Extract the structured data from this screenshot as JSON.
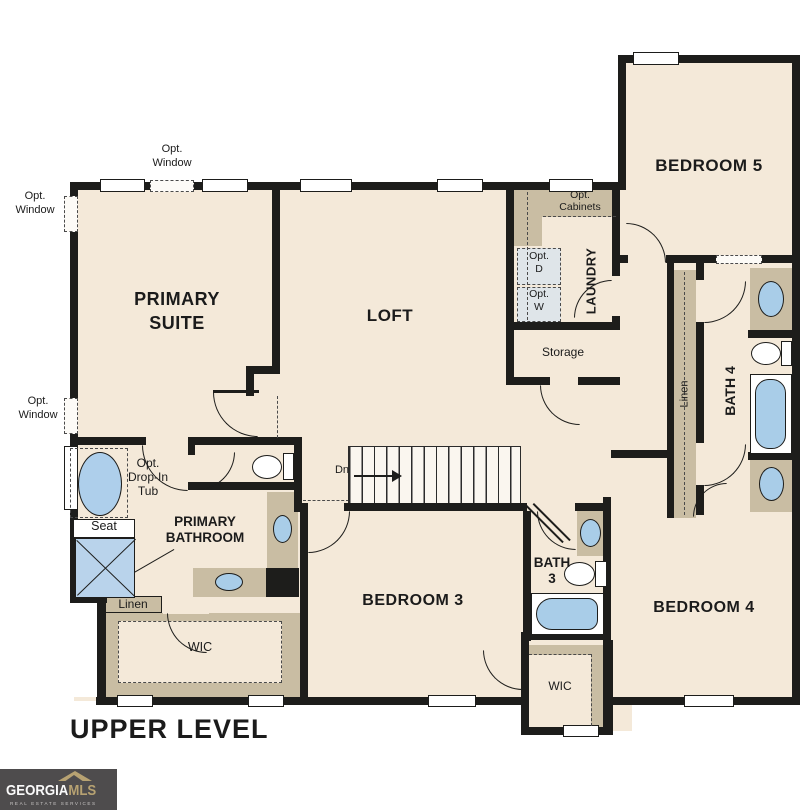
{
  "colors": {
    "wall": "#1d1d1b",
    "floor": "#f4e9d9",
    "cabinet_tan": "#c9bda3",
    "fixture_blue": "#a9cde8",
    "opt_box": "#dfe5e9",
    "logo_bg": "#4e4c4d",
    "logo_gold": "#b7a272"
  },
  "plan": {
    "level_title": "UPPER LEVEL",
    "rooms": {
      "primary_suite_1": "PRIMARY",
      "primary_suite_2": "SUITE",
      "loft": "LOFT",
      "laundry": "LAUNDRY",
      "storage": "Storage",
      "bedroom5": "BEDROOM 5",
      "bath4": "BATH 4",
      "linen_right": "Linen",
      "primary_bath_1": "PRIMARY",
      "primary_bath_2": "BATHROOM",
      "linen_left": "Linen",
      "wic_primary": "WIC",
      "bedroom3": "BEDROOM 3",
      "bath3_1": "BATH",
      "bath3_2": "3",
      "wic_bedroom3": "WIC",
      "bedroom4": "BEDROOM 4"
    },
    "annotations": {
      "opt": "Opt.",
      "window": "Window",
      "cabinets": "Cabinets",
      "dryer": "D",
      "washer": "W",
      "drop_in": "Drop-In",
      "tub": "Tub",
      "seat": "Seat",
      "down": "Dn"
    }
  },
  "logo": {
    "brand_1": "GEORGIA",
    "brand_2": "MLS",
    "tagline": "REAL ESTATE SERVICES"
  }
}
